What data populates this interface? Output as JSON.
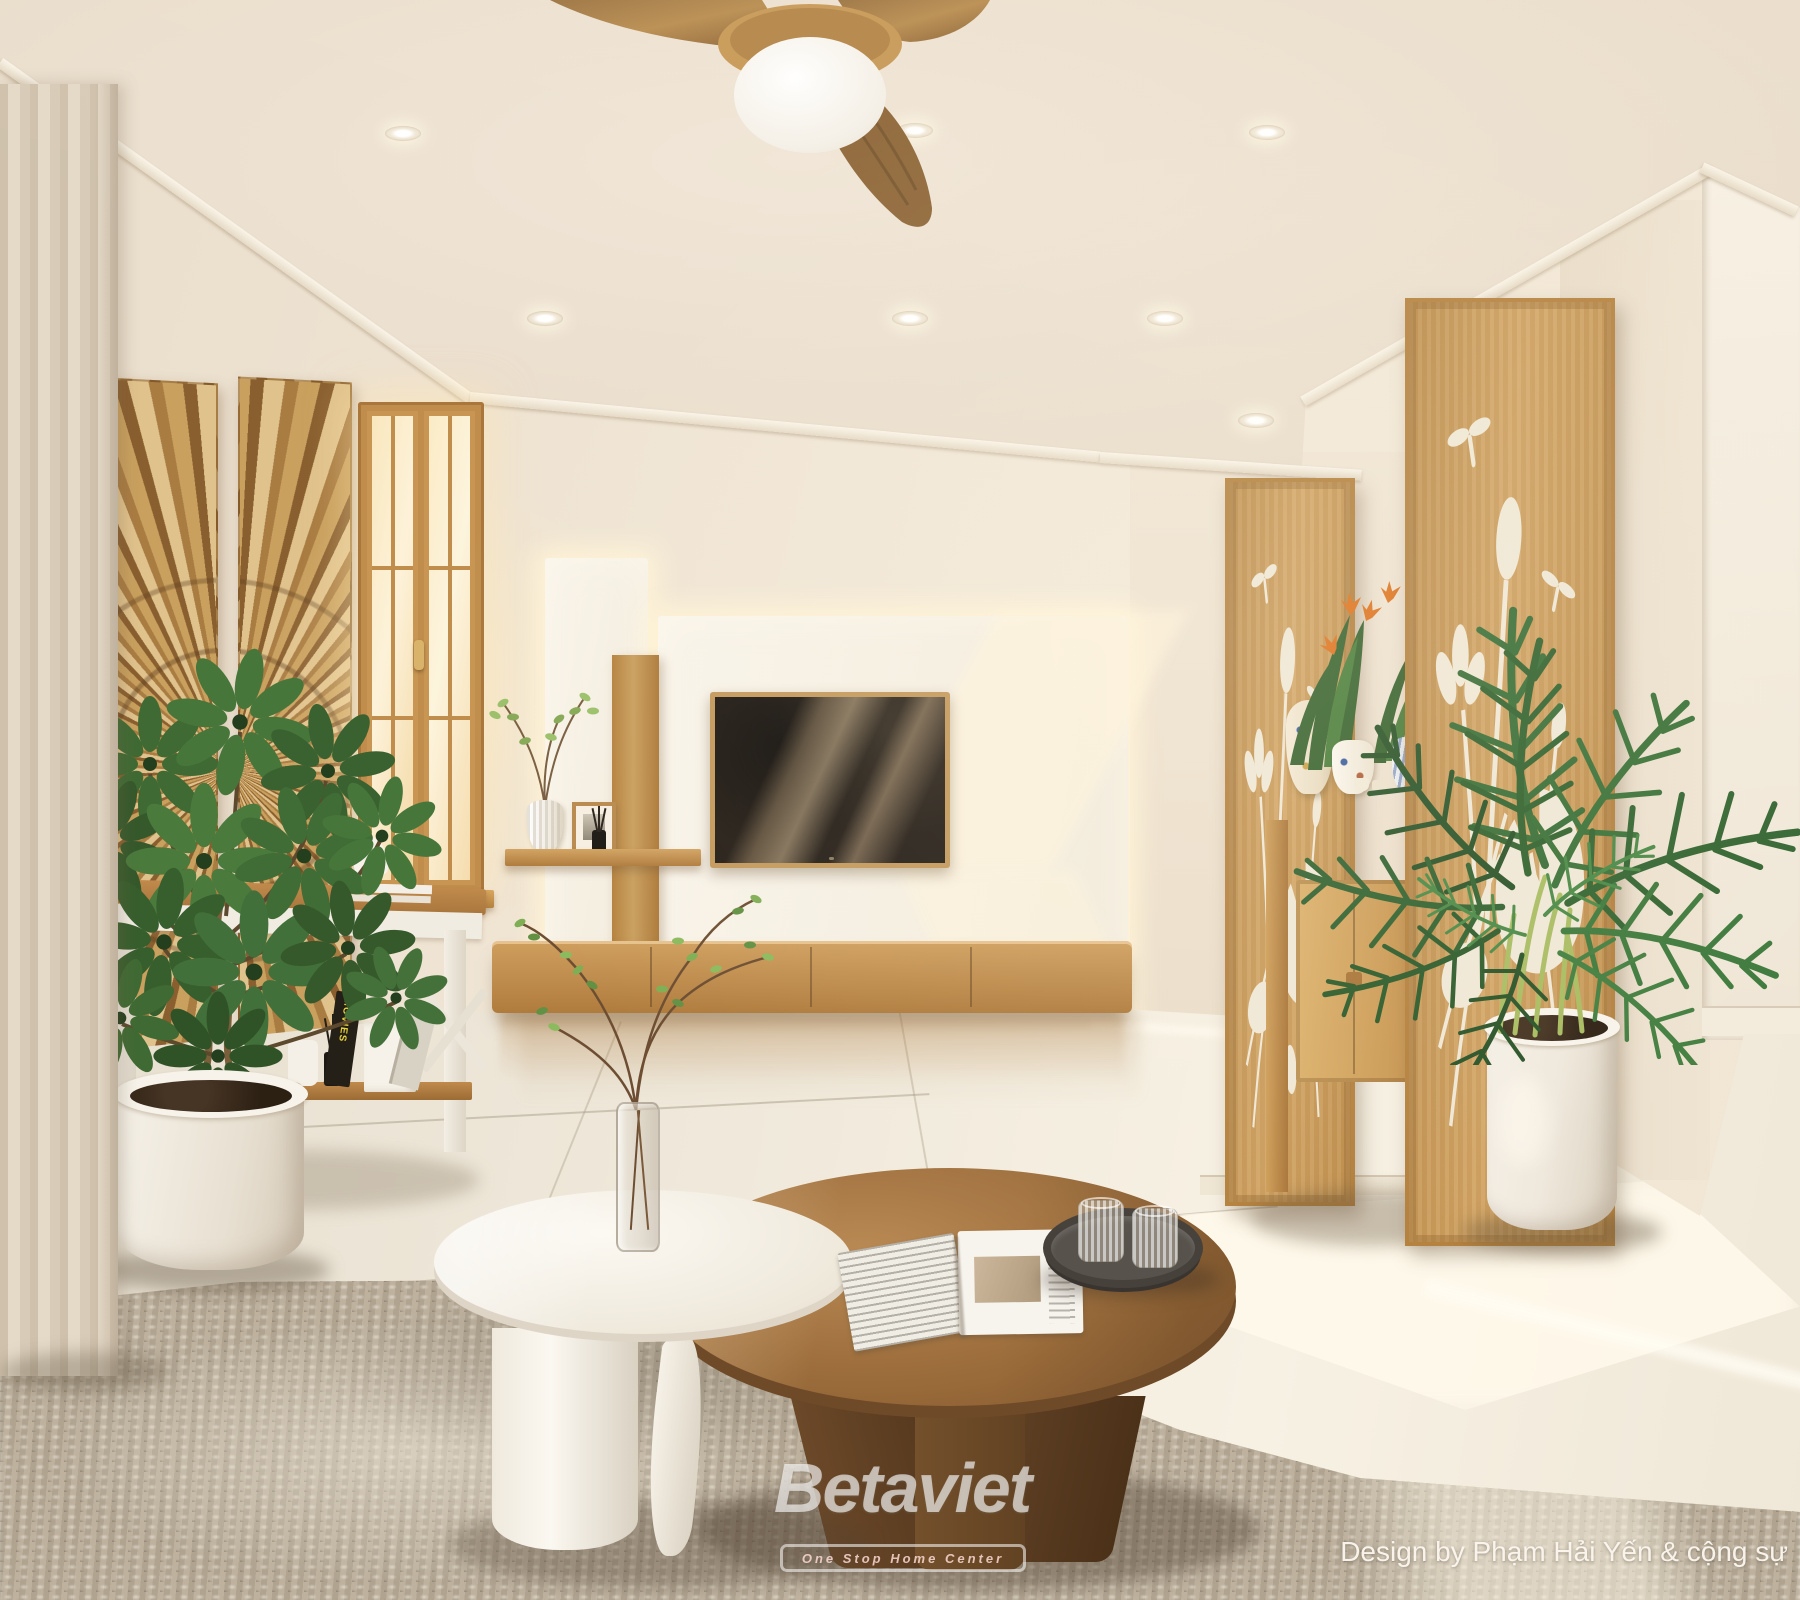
{
  "meta": {
    "kind": "interior-3d-render",
    "room": "living-room",
    "style": "japandi-neoclassic",
    "width_px": 1800,
    "height_px": 1600
  },
  "watermark": {
    "brand": "Betaviet",
    "tagline": "One Stop Home Center",
    "credit": "Design by Phạm Hải Yến & cộng sự"
  },
  "labels": {
    "book_spine": "MOVIES"
  },
  "palette": {
    "wall": "#eee3d3",
    "wall_shadow": "#e3d6c3",
    "ceiling": "#ece1d2",
    "molding": "#f6efe4",
    "wood": "#c79757",
    "wood_dark": "#8a5f30",
    "wood_light": "#dcb277",
    "floor": "#ece5d8",
    "floor_bright": "#fbf6ec",
    "rug": "#b4a794",
    "rug_light": "#d6cbb8",
    "rug_dark": "#847868",
    "curtain": "#dccfbc",
    "leaf_dark": "#2f5229",
    "leaf": "#47723a",
    "leaf_light": "#69984a",
    "palm": "#2e5c31",
    "tv_screen": "#261f18",
    "white_furniture": "#f6f2ea",
    "porcelain_blue": "#3f5f9e",
    "flower_orange": "#e0741f",
    "glow": "#fff3d8",
    "pot_white": "#f1ece3",
    "table_wood": "#9a6b3e",
    "table_wood_dark": "#6b4526"
  },
  "scene": {
    "objects": [
      "ceiling fan with light",
      "recessed downlights",
      "sheer curtain",
      "wood sunburst wall art",
      "wood casement window",
      "white console table with books and diffuser",
      "schefflera plant in white pot",
      "backlit tv feature wall",
      "wall-mounted tv",
      "floating wood media cabinet",
      "wood shelf with vase and photo frame",
      "carved lotus wood altar panels",
      "wood altar table with porcelain vases and flowers",
      "areca palm in white planter",
      "round white coffee table",
      "round walnut coffee table",
      "glass vase with green branches",
      "open magazine",
      "dark round tray with two ribbed glasses",
      "woven jute rug",
      "polished tile floor"
    ]
  }
}
